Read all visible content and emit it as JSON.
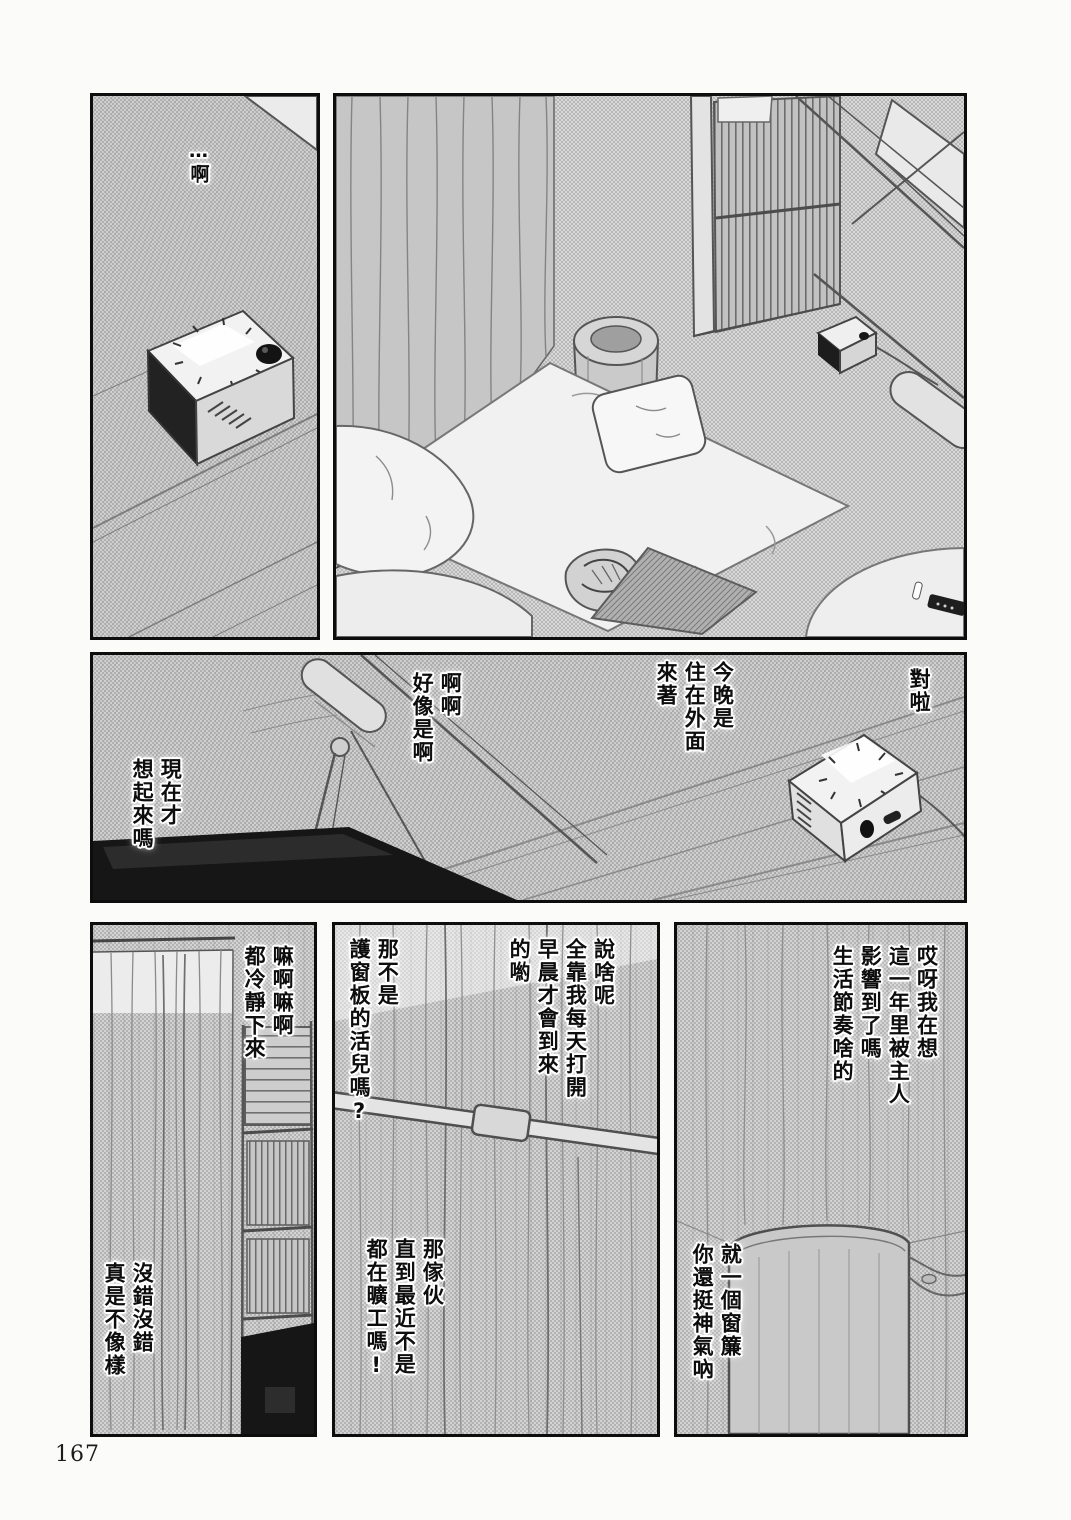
{
  "page_number": "167",
  "panels": {
    "top_left": {
      "ah": "…啊"
    },
    "middle": {
      "right_exclaim": "對啦",
      "tonight": "今晚是\n住在外面\n來著",
      "agree": "啊啊\n好像是啊",
      "now_remember": "現在才\n想起來嗎"
    },
    "bottom_right": {
      "thinking": "哎呀我在想\n這一年里被主人\n影響到了嗎\n生活節奏啥的",
      "curtain_taunt": "就一個窗簾\n你還挺神氣吶"
    },
    "bottom_middle": {
      "retort": "說啥呢\n全靠我每天打開\n早晨才會到來\n的喲",
      "shutter_job": "那不是\n護窗板的活兒嗎?",
      "slacker": "那傢伙\n直到最近不是\n都在曠工嗎!"
    },
    "bottom_left": {
      "calm_down": "嘛啊嘛啊\n都冷靜下來",
      "shameful": "沒錯沒錯\n真是不像樣"
    }
  }
}
